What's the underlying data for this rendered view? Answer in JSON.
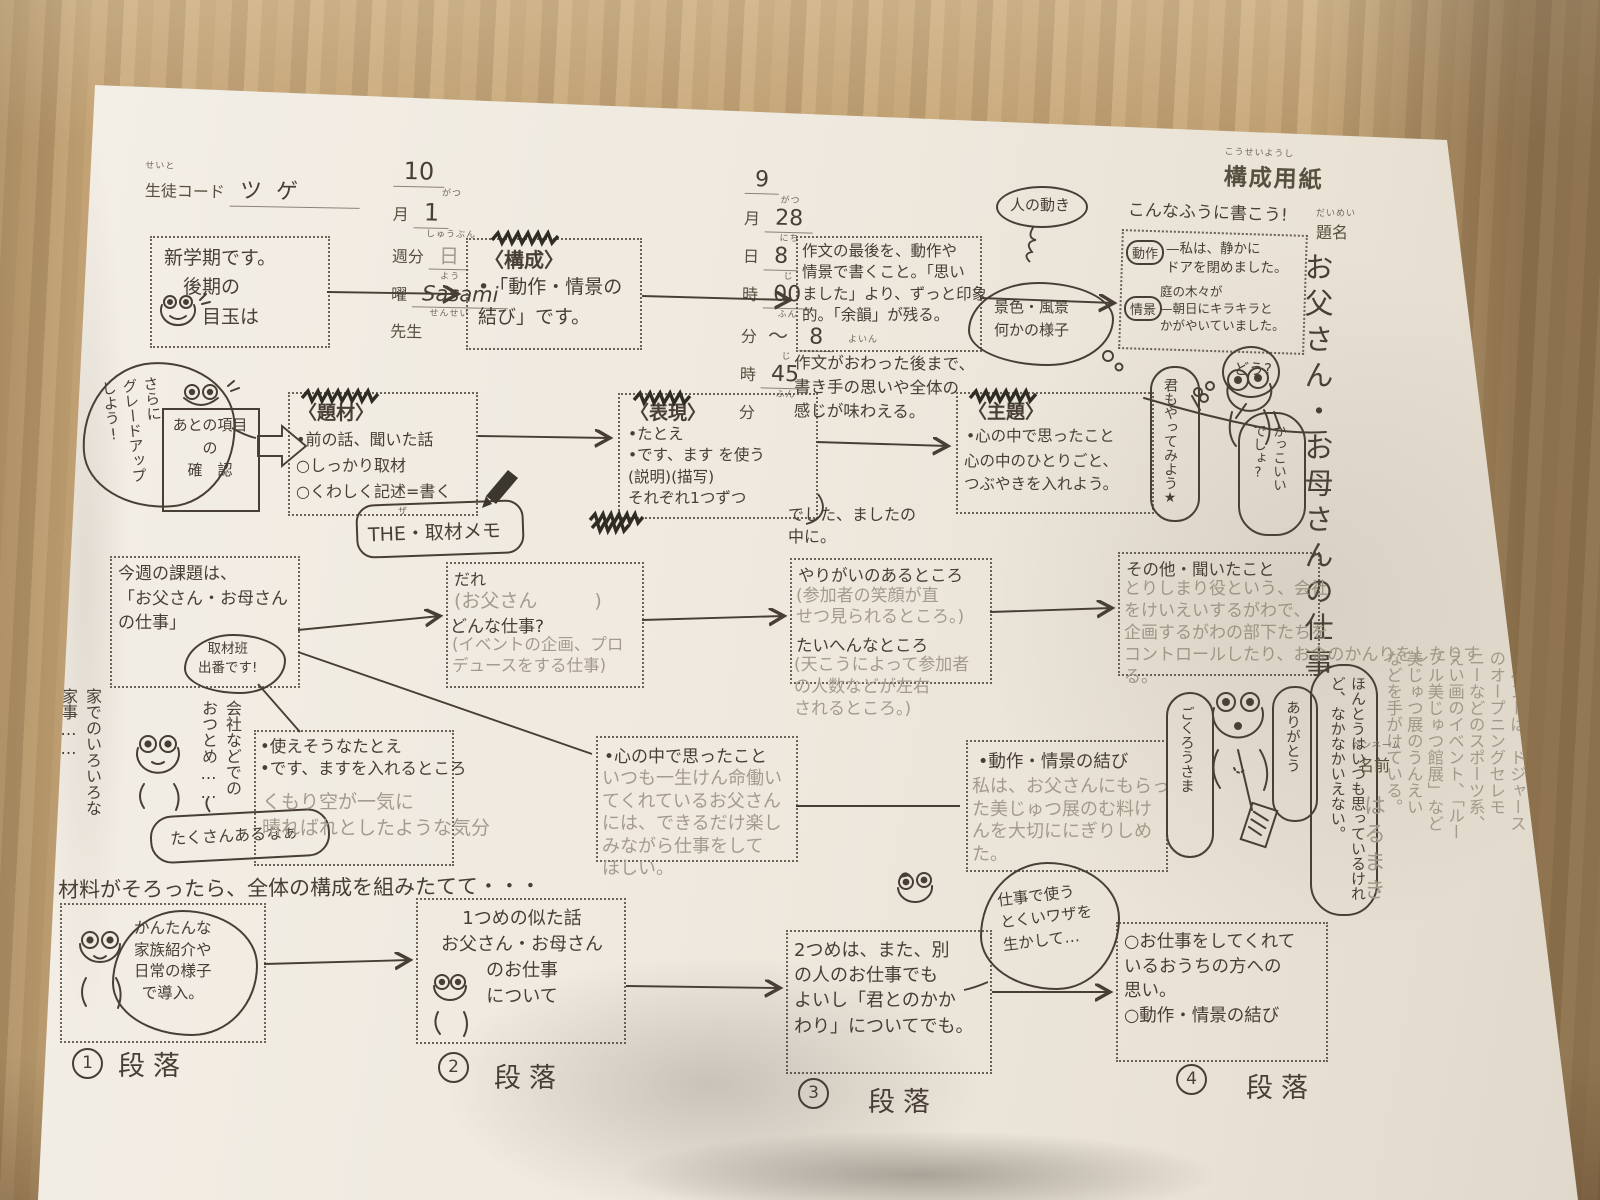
{
  "colors": {
    "ink": "#473f35",
    "pencil": "#a49b8c",
    "paper": "#f0ebe2",
    "wood": "#bd9e70"
  },
  "page": {
    "sheet_title": "構成用紙",
    "sheet_title_furigana": "こうせいようし",
    "write_hint": "こんなふうに書こう!"
  },
  "header": {
    "student_label": "生徒コード",
    "student_furigana": "せいと",
    "student_value": "ツゲ",
    "month_value": "10",
    "month_label": "月",
    "month_furigana": "がつ",
    "week_value": "1",
    "week_label": "週分",
    "week_furigana": "しゅうぶん",
    "weekday_value": "日",
    "weekday_label": "曜",
    "weekday_furigana": "よう",
    "teacher_value": "Sasami",
    "teacher_label": "先生",
    "teacher_furigana": "せんせい",
    "date_month": "9",
    "date_month_label": "月",
    "date_month_furigana": "がつ",
    "date_day": "28",
    "date_day_label": "日",
    "date_day_furigana": "にち",
    "start_hour": "8",
    "hour_label": "時",
    "hour_furigana": "じ",
    "start_min": "00",
    "min_label": "分",
    "min_furigana": "ふん",
    "tilde": "〜",
    "end_hour": "8",
    "end_min": "45"
  },
  "title": {
    "label": "題名",
    "furigana": "だいめい",
    "value": "お父さん・お母さんの仕事"
  },
  "flow1": {
    "box1": "新学期です。\n　後期の\n　　目玉は",
    "box2_head": "〈構成〉",
    "box2_body": "•「動作・情景の\n結び」です。",
    "box3": "作文の最後を、動作や\n情景で書くこと。「思い\nました」より、ずっと印象\n的。「余韻」が残る。",
    "box3_furigana": "よいん",
    "after_note": "作文がおわった後まで、\n書き手の思いや全体の\n感じが味わえる。",
    "bubble_motion": "人の動き",
    "cloud_scene": "景色・風景\n何かの様子",
    "ex_dousa_label": "動作",
    "ex_dousa_text": "—私は、静かに\nドアを閉めました。",
    "ex_jokei_label": "情景",
    "ex_jokei_text": "庭の木々が\n—朝日にキラキラと\nかがやいていました。"
  },
  "flow2": {
    "bubble_upgrade": "さらに\nグレードアップ\nしよう!",
    "check_box": "あとの項目\nの\n確　認",
    "material_head": "〈題材〉",
    "material_items": [
      "•前の話、聞いた話",
      "○しっかり取材",
      "○くわしく記述=書く"
    ],
    "memo_furigana": "ザ",
    "memo": "THE・取材メモ",
    "expr_head": "〈表現〉",
    "expr_body": "•たとえ\n•です、ます を使う\n(説明)(描写)\nそれぞれ1つずつ",
    "expr_note": "でした、ましたの\n中に。",
    "theme_head": "〈主題〉",
    "theme_1": "•心の中で思ったこと",
    "theme_2": "心の中のひとりごと、\nつぶやきを入れよう。",
    "bubble_you": "君もやってみよう★",
    "bubble_how": "どう?",
    "bubble_cool": "かっこいい\nでしょ?"
  },
  "flow3": {
    "task": "今週の課題は、\n「お父さん・お母さん\nの仕事」",
    "task_bubble": "取材班\n出番です!",
    "who_label": "だれ",
    "who_value": "(お父さん　　　)",
    "job_label": "どんな仕事?",
    "job_value": "(イベントの企画、プロ\nデュースをする仕事)",
    "reward_label": "やりがいのあるところ",
    "reward_value": "(参加者の笑顔が直\nせつ見られるところ。)",
    "hard_label": "たいへんなところ",
    "hard_value": "(天こうによって参加者\nの人数などが左右\nされるところ。)",
    "other_label": "その他・聞いたこと",
    "other_value": "とりしまり役という、会社\nをけいえいするがわで、\n企画するがわの部下たちを\nコントロールしたり、お金のかんりをしたりす\nる。",
    "chore_note": "家でのいろいろな\n家事……",
    "office_note": "会社などでの\nおつとめ……",
    "frog_bubble": "たくさんあるなぁ"
  },
  "flow4": {
    "simile_label": "•使えそうなたとえ\n•です、ますを入れるところ",
    "simile_value": "くもり空が一気に\n晴ればれとしたような気分",
    "heart_label": "•心の中で思ったこと",
    "heart_value": "いつも一生けん命働い\nてくれているお父さん\nには、できるだけ楽し\nみながら仕事をして\nほしい。",
    "ending_label": "•動作・情景の結び",
    "ending_value": "私は、お父さんにもらっ\nた美じゅつ展のむ料け\nんを大切ににぎりしめ\nた。",
    "bubble_gokurou": "ごくろうさま",
    "bubble_arigatou": "ありがとう",
    "bubble_honto": "ほんとうはいつも思っているけれど、なかなかいえない。"
  },
  "margin": {
    "penname_furigana": "ペンネーム",
    "penname_label": "名前",
    "penname_value": "はるまき",
    "note": "イベントは、ドジャース\nのオープニングセレモ\nニーなどのスポーツ系、\nえい画のイベント、「ルー\nブル美じゅつ館展」など\n美じゅつ展のうんえい\nなどを手がけている。"
  },
  "structure": {
    "lead": "材料がそろったら、全体の構成を組みたてて・・・",
    "p1": "かんたんな\n家族紹介や\n日常の様子\nで導入。",
    "p2": "1つめの似た話\nお父さん・お母さん\nのお仕事\nについて",
    "p3": "2つめは、また、別\nの人のお仕事でも\nよいし「君とのかか\nわり」についてでも。",
    "p4": "○お仕事をしてくれて\nいるおうちの方への\n思い。\n○動作・情景の結び",
    "bubble_skill": "仕事で使う\nとくいワザを\n生かして…",
    "num1": "1",
    "num2": "2",
    "num3": "3",
    "num4": "4",
    "paragraph_label": "段落"
  }
}
